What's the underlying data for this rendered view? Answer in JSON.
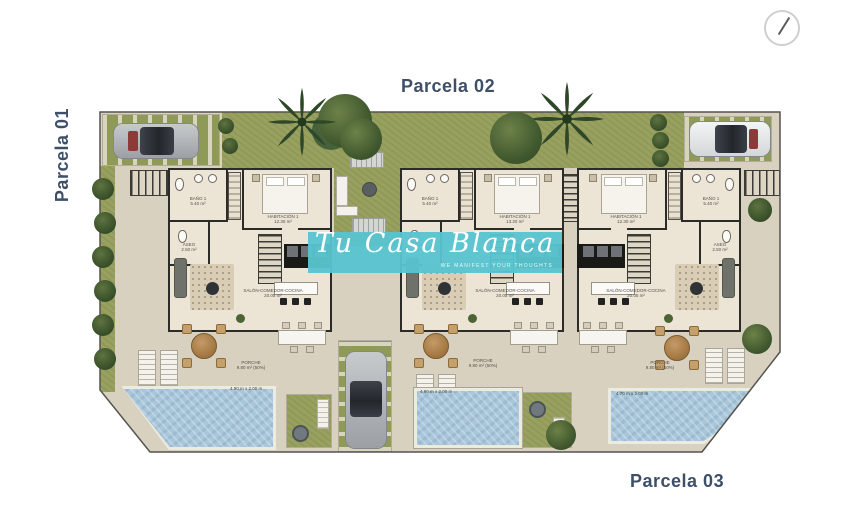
{
  "titles": {
    "parcela_01": "Parcela 01",
    "parcela_02": "Parcela 02",
    "parcela_03": "Parcela 03"
  },
  "watermark": {
    "brand": "Tu Casa Blanca",
    "tagline": "WE MANIFEST YOUR THOUGHTS"
  },
  "units": [
    {
      "rooms": {
        "bano": {
          "label": "BAÑO 1",
          "area": "5.40 m²"
        },
        "habitacion": {
          "label": "HABITACIÓN 1",
          "area": "12.30 m²"
        },
        "aseo": {
          "label": "ASEO",
          "area": "2.50 m²"
        },
        "salon": {
          "label": "SALÓN-COMEDOR-COCINA",
          "area": "20.05 m²"
        },
        "porche": {
          "label": "PORCHE",
          "area": "9.80 m² (50%)"
        }
      },
      "pool": {
        "dims": "4.90 m x 2.00 m"
      }
    },
    {
      "rooms": {
        "bano": {
          "label": "BAÑO 1",
          "area": "5.40 m²"
        },
        "habitacion": {
          "label": "HABITACIÓN 1",
          "area": "13.20 m²"
        },
        "aseo": {
          "label": "ASEO",
          "area": "2.50 m²"
        },
        "salon": {
          "label": "SALÓN-COMEDOR-COCINA",
          "area": "20.05 m²"
        },
        "porche": {
          "label": "PORCHE",
          "area": "9.80 m² (50%)"
        }
      },
      "pool": {
        "dims": "4.90 m x 2.00 m"
      }
    },
    {
      "rooms": {
        "bano": {
          "label": "BAÑO 1",
          "area": "5.40 m²"
        },
        "habitacion": {
          "label": "HABITACIÓN 1",
          "area": "12.30 m²"
        },
        "aseo": {
          "label": "ASEO",
          "area": "2.50 m²"
        },
        "salon": {
          "label": "SALÓN-COMEDOR-COCINA",
          "area": "20.05 m²"
        },
        "porche": {
          "label": "PORCHE",
          "area": "9.80 m² (50%)"
        }
      },
      "pool": {
        "dims": "4.70 m x 2.00 m"
      }
    }
  ],
  "colors": {
    "watermark_teal": "#58c4cf",
    "parcela_label": "#3e4f69",
    "grass": "#99a161",
    "paving": "#d8d1c0",
    "pool_water": "#a9c6da",
    "walls": "#2b2b28"
  }
}
